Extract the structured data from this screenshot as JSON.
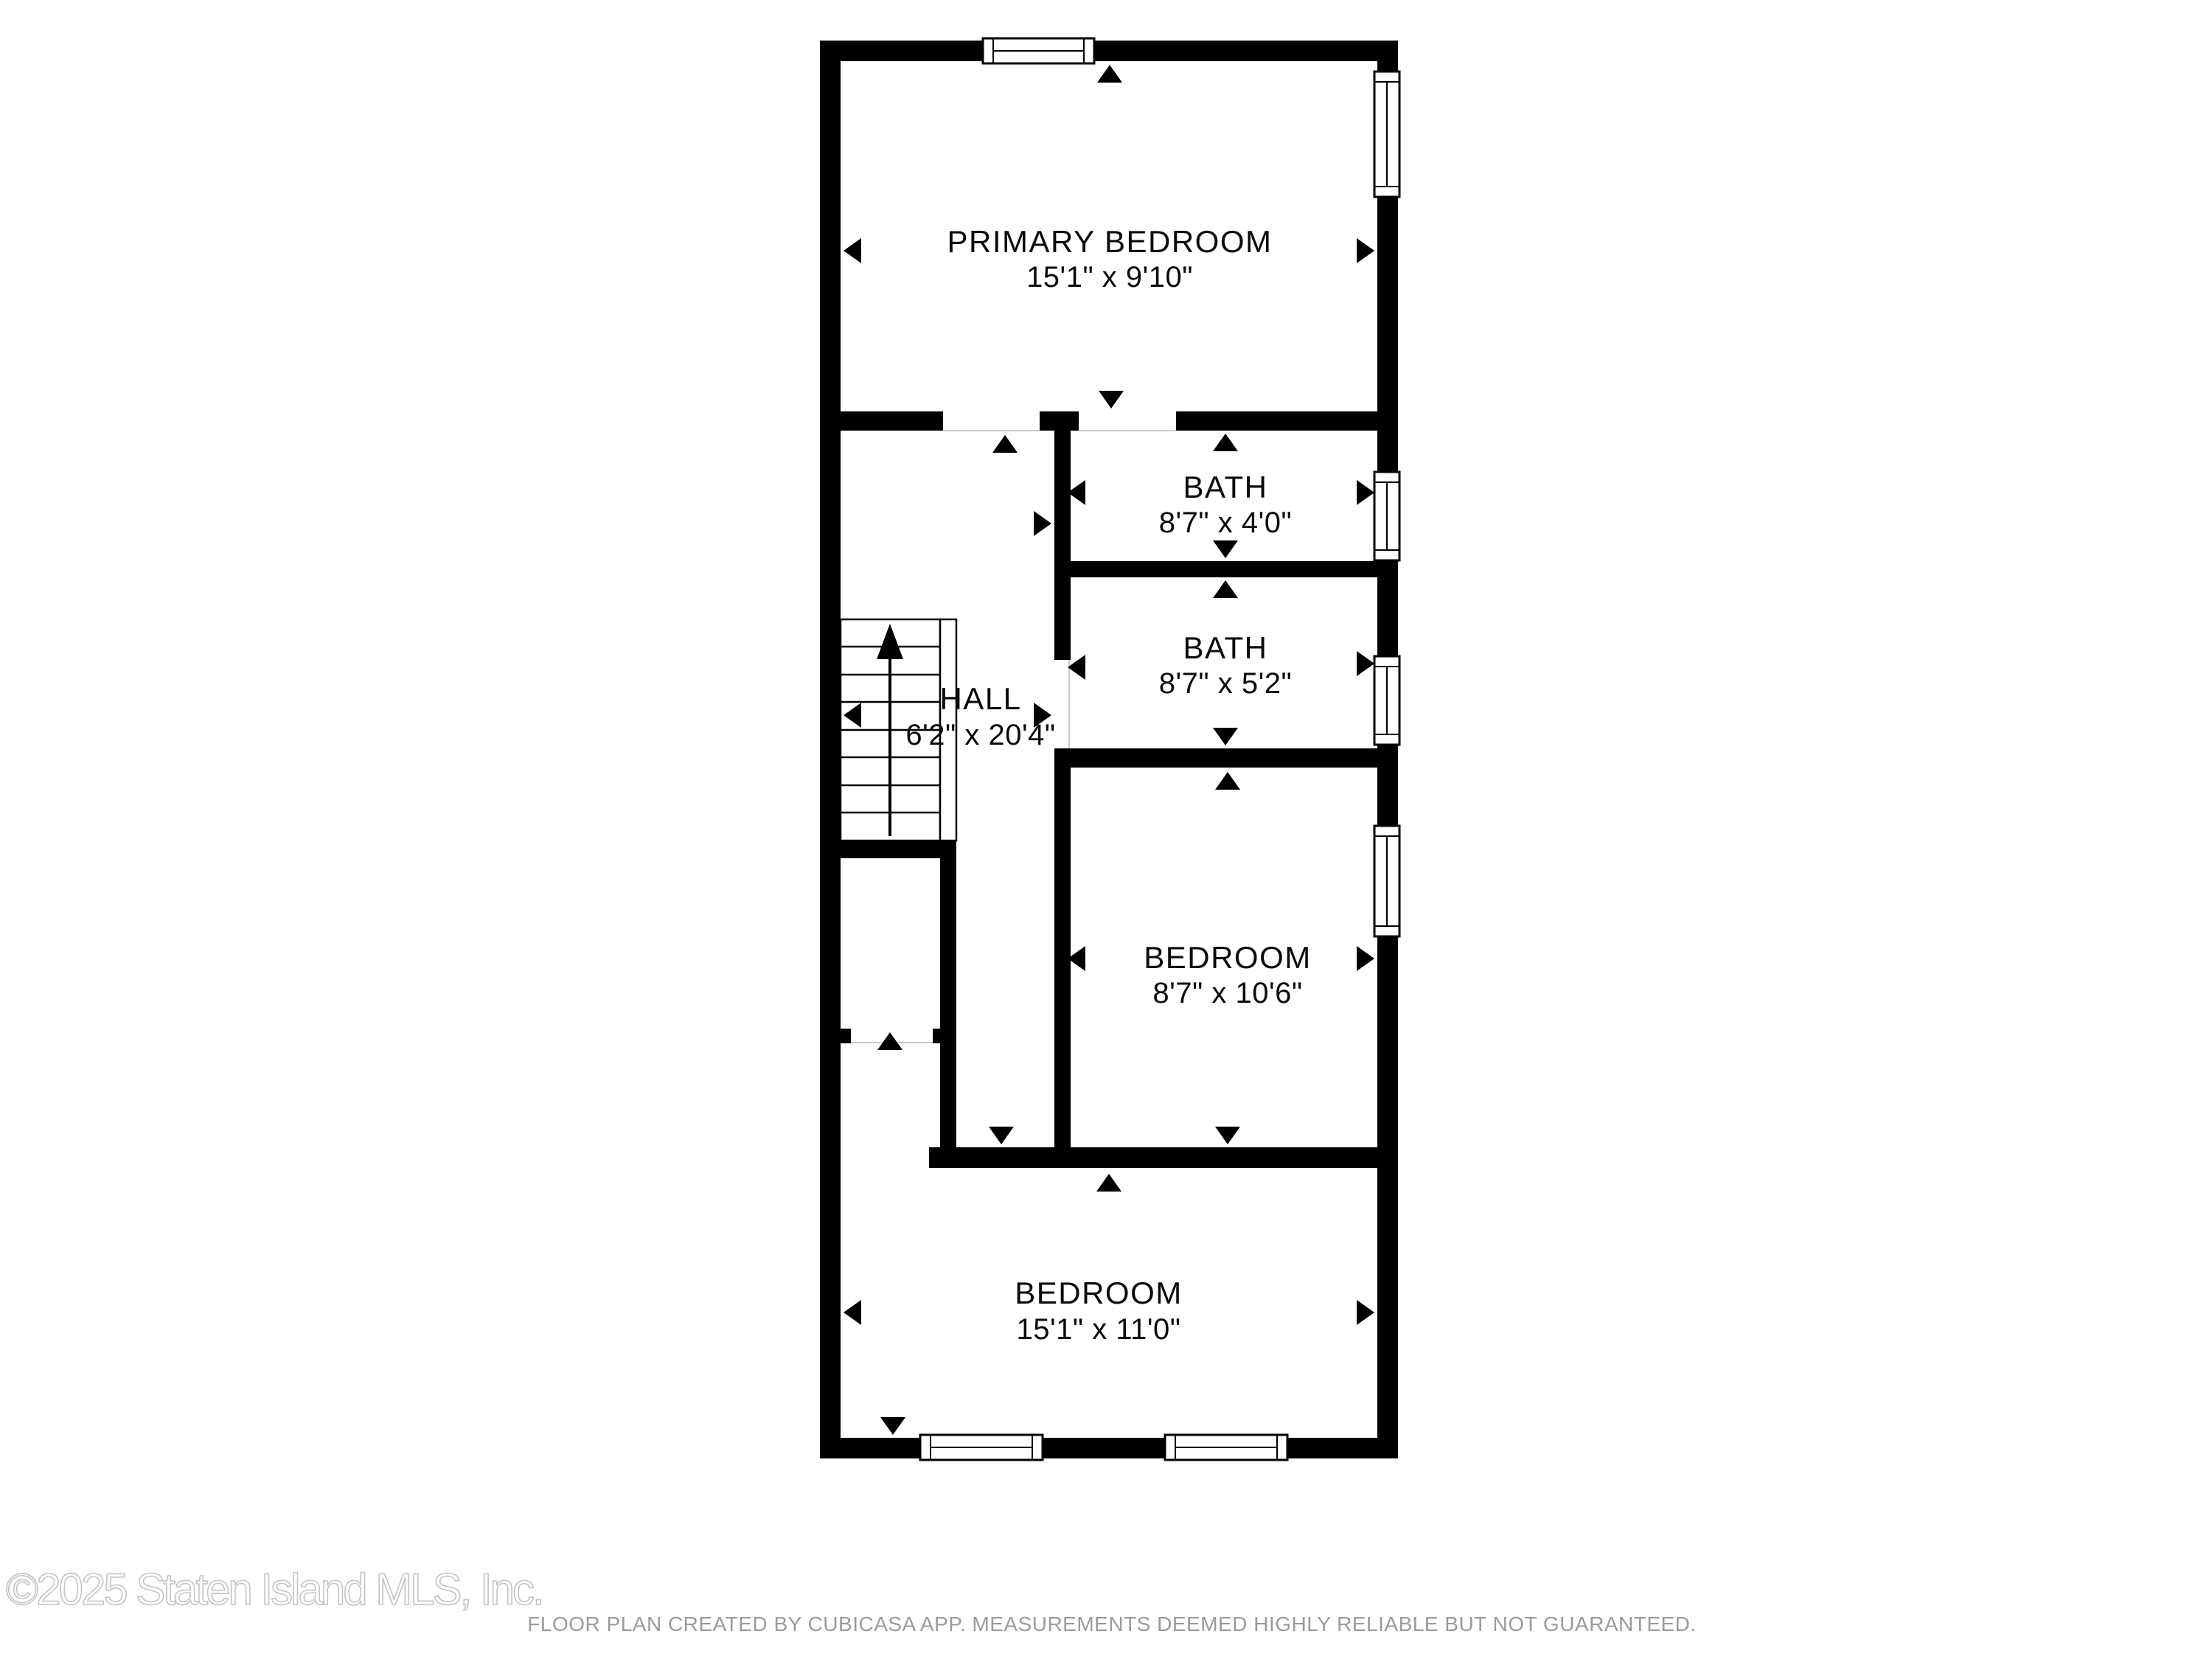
{
  "plan": {
    "floor_name": "floor-plan",
    "rooms": [
      {
        "name": "PRIMARY BEDROOM",
        "dims": "15'1\" x 9'10\""
      },
      {
        "name": "BATH",
        "dims": "8'7\" x 4'0\""
      },
      {
        "name": "BATH",
        "dims": "8'7\" x 5'2\""
      },
      {
        "name": "BEDROOM",
        "dims": "8'7\" x 10'6\""
      },
      {
        "name": "HALL",
        "dims": "6'2\" x 20'4\""
      },
      {
        "name": "BEDROOM",
        "dims": "15'1\" x 11'0\""
      }
    ]
  },
  "footer": {
    "watermark": "©2025 Staten Island MLS, Inc.",
    "disclaimer": "FLOOR PLAN CREATED BY CUBICASA APP. MEASUREMENTS DEEMED HIGHLY RELIABLE BUT NOT GUARANTEED."
  },
  "colors": {
    "wall": "#000000",
    "arrow": "#000000",
    "watermark": "#c4c4c4",
    "disclaimer": "#9b9b9b"
  }
}
